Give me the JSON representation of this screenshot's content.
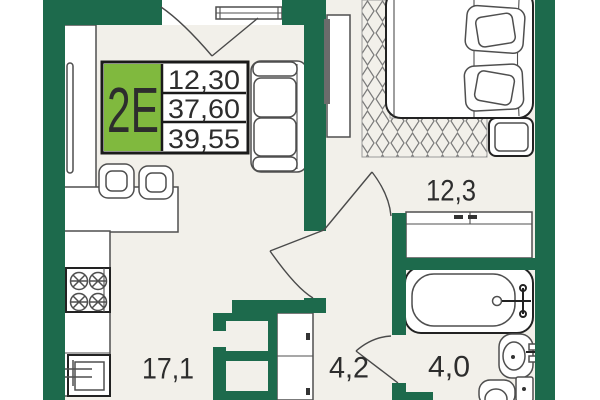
{
  "unit_card": {
    "unit_label": "2Е",
    "areas": [
      "12,30",
      "37,60",
      "39,55"
    ]
  },
  "rooms": [
    {
      "name": "kitchen-living",
      "area": "17,1"
    },
    {
      "name": "bedroom",
      "area": "12,3"
    },
    {
      "name": "hallway",
      "area": "4,2"
    },
    {
      "name": "bathroom",
      "area": "4,0"
    }
  ],
  "colors": {
    "wall_green": "#1d6a4c",
    "accent_green": "#80b93e",
    "floor": "#f2f0ea",
    "outside": "#ffffff",
    "ink": "#2d2d2d"
  }
}
